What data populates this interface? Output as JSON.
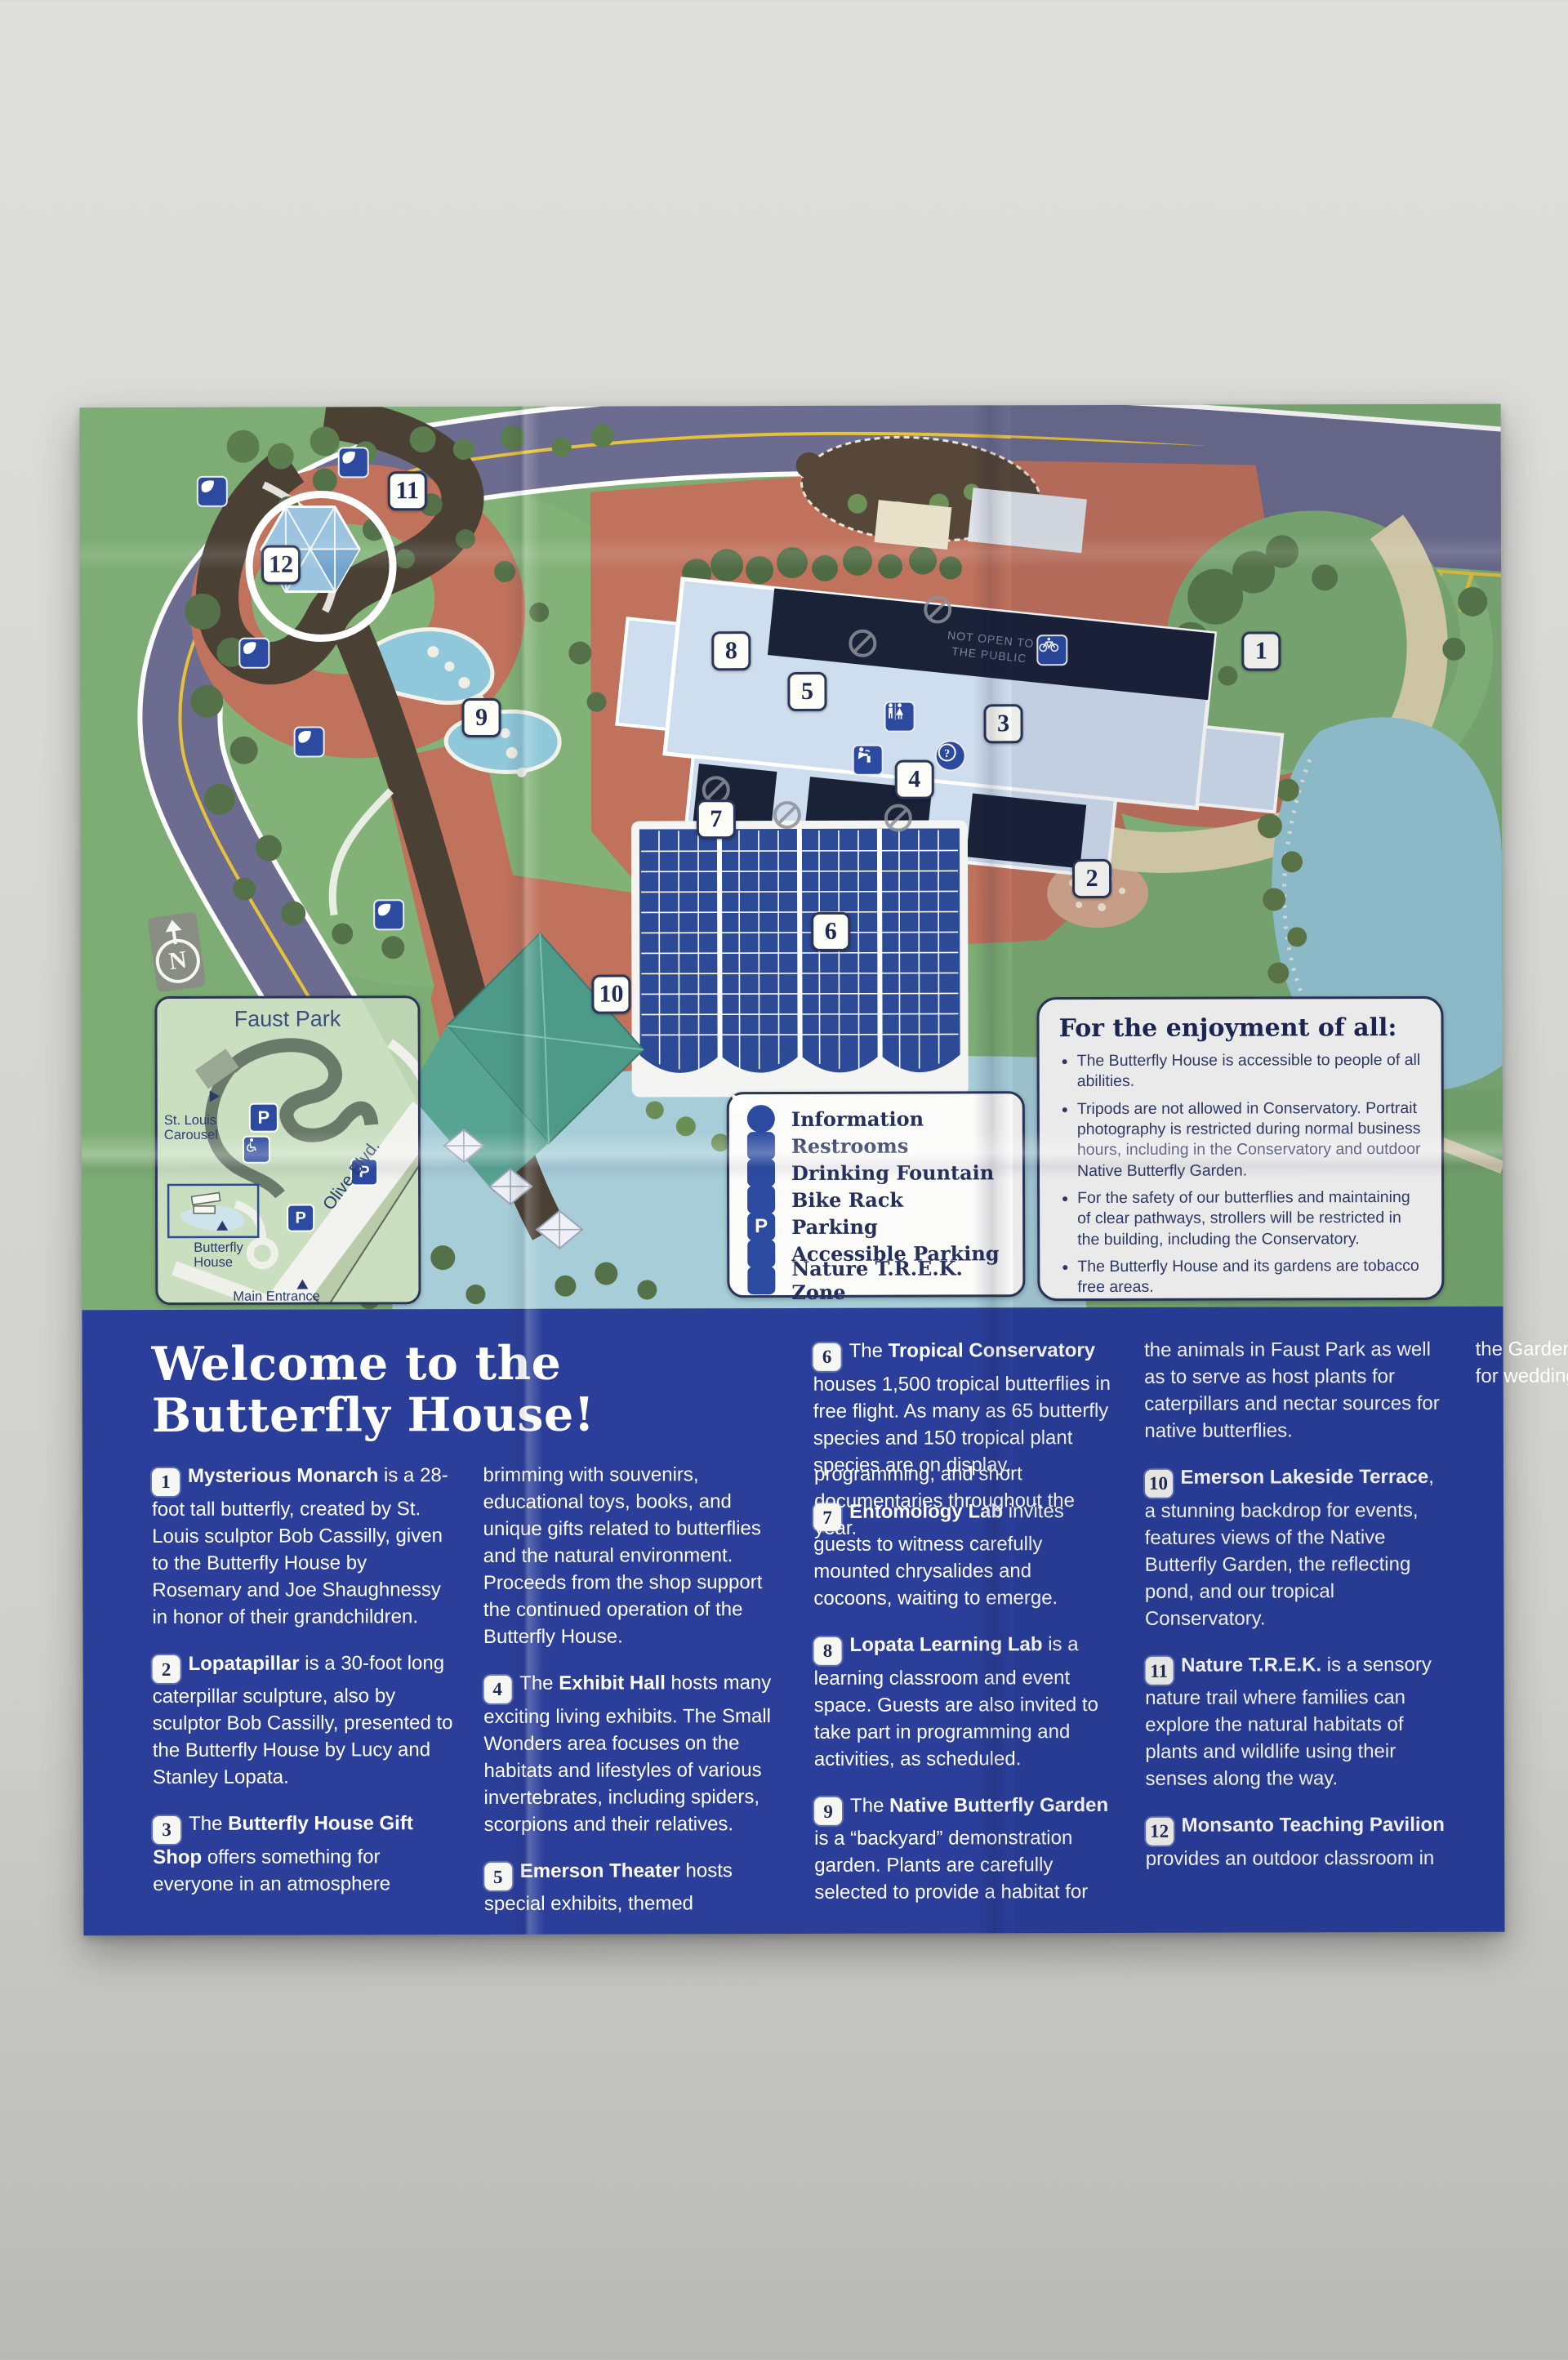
{
  "map": {
    "markers": [
      "1",
      "2",
      "3",
      "4",
      "5",
      "6",
      "7",
      "8",
      "9",
      "10",
      "11",
      "12"
    ],
    "not_open_line1": "NOT OPEN TO",
    "not_open_line2": "THE PUBLIC",
    "north_label": "N"
  },
  "legend": {
    "items": [
      {
        "icon": "information-icon",
        "label": "Information"
      },
      {
        "icon": "restrooms-icon",
        "label": "Restrooms"
      },
      {
        "icon": "drinking-fountain-icon",
        "label": "Drinking Fountain"
      },
      {
        "icon": "bike-rack-icon",
        "label": "Bike Rack"
      },
      {
        "icon": "parking-icon",
        "label": "Parking"
      },
      {
        "icon": "accessible-parking-icon",
        "label": "Accessible Parking"
      },
      {
        "icon": "nature-trek-icon",
        "label": "Nature T.R.E.K. Zone"
      }
    ]
  },
  "enjoyment": {
    "title": "For the enjoyment of all:",
    "bullets": [
      "The Butterfly House is accessible to people of all abilities.",
      "Tripods are not allowed in Conservatory. Portrait photography is restricted during normal business hours, including in the Conservatory and outdoor Native Butterfly Garden.",
      "For the safety of our butterflies and maintaining of clear pathways, strollers will be restricted in the building, including the Conservatory.",
      "The Butterfly House and its gardens are tobacco free areas.",
      "Food and drink not allowed in the Conservatory."
    ]
  },
  "inset": {
    "title": "Faust Park",
    "carousel_label": "St. Louis Carousel",
    "butterfly_house_label": "Butterfly House",
    "main_entrance_label": "Main Entrance",
    "olive_blvd_label": "Olive Blvd.",
    "parking_letter": "P"
  },
  "welcome": {
    "title_line1": "Welcome to the",
    "title_line2": "Butterfly House!",
    "items": [
      {
        "number": "1",
        "pre": "",
        "bold": "Mysterious Monarch",
        "text": " is a 28-foot tall butterfly, created by St. Louis sculptor Bob Cassilly, given to the Butterfly House by Rosemary and Joe Shaughnessy in honor of their grandchildren."
      },
      {
        "number": "2",
        "pre": "",
        "bold": "Lopatapillar",
        "text": " is a 30-foot long caterpillar sculpture, also by sculptor Bob Cassilly, presented to the Butterfly House by Lucy and Stanley Lopata."
      },
      {
        "number": "3",
        "pre": "The ",
        "bold": "Butterfly House Gift Shop",
        "text": " offers something for everyone in an atmosphere brimming with souvenirs, educational toys, books, and unique gifts related to butterflies and the natural environment. Proceeds from the shop support the continued operation of the Butterfly House."
      },
      {
        "number": "4",
        "pre": "The ",
        "bold": "Exhibit Hall",
        "text": " hosts many exciting living exhibits. The Small Wonders area focuses on the habitats and lifestyles of various invertebrates, including spiders, scorpions and their relatives."
      },
      {
        "number": "5",
        "pre": "",
        "bold": "Emerson Theater",
        "text": " hosts special exhibits, themed programming, and short documentaries throughout the year."
      },
      {
        "number": "6",
        "pre": "The ",
        "bold": "Tropical Conservatory",
        "text": " houses 1,500 tropical butterflies in free flight. As many as 65 butterfly species and 150 tropical plant species are on display."
      },
      {
        "number": "7",
        "pre": "",
        "bold": "Entomology Lab",
        "text": " invites guests to witness carefully mounted chrysalides and cocoons, waiting to emerge."
      },
      {
        "number": "8",
        "pre": "",
        "bold": "Lopata Learning Lab",
        "text": " is a learning classroom and event space. Guests are also invited to take part in programming and activities, as scheduled."
      },
      {
        "number": "9",
        "pre": "The ",
        "bold": "Native Butterfly Garden",
        "text": " is a “backyard” demonstration garden. Plants are carefully selected to provide a habitat for the animals in Faust Park as well as to serve as host plants for caterpillars and nectar sources for native butterflies."
      },
      {
        "number": "10",
        "pre": "",
        "bold": "Emerson Lakeside Terrace",
        "text": ", a stunning backdrop for events, features views of the Native Butterfly Garden, the reflecting pond, and our tropical Conservatory."
      },
      {
        "number": "11",
        "pre": "",
        "bold": "Nature T.R.E.K.",
        "text": " is a sensory nature trail where families can explore the natural habitats of plants and wildlife using their senses along the way."
      },
      {
        "number": "12",
        "pre": "",
        "bold": "Monsanto Teaching Pavilion",
        "text": " provides an outdoor classroom in the Garden and a beautiful setting for wedding ceremonies."
      }
    ]
  },
  "colors": {
    "panel_blue": "#2b3f9a",
    "map_green": "#7dad74",
    "road_purple": "#6c6c90",
    "plaza_red": "#c0725c",
    "water_blue": "#96c6d4",
    "icon_blue": "#2b4aa0",
    "navy": "#2a3558"
  }
}
